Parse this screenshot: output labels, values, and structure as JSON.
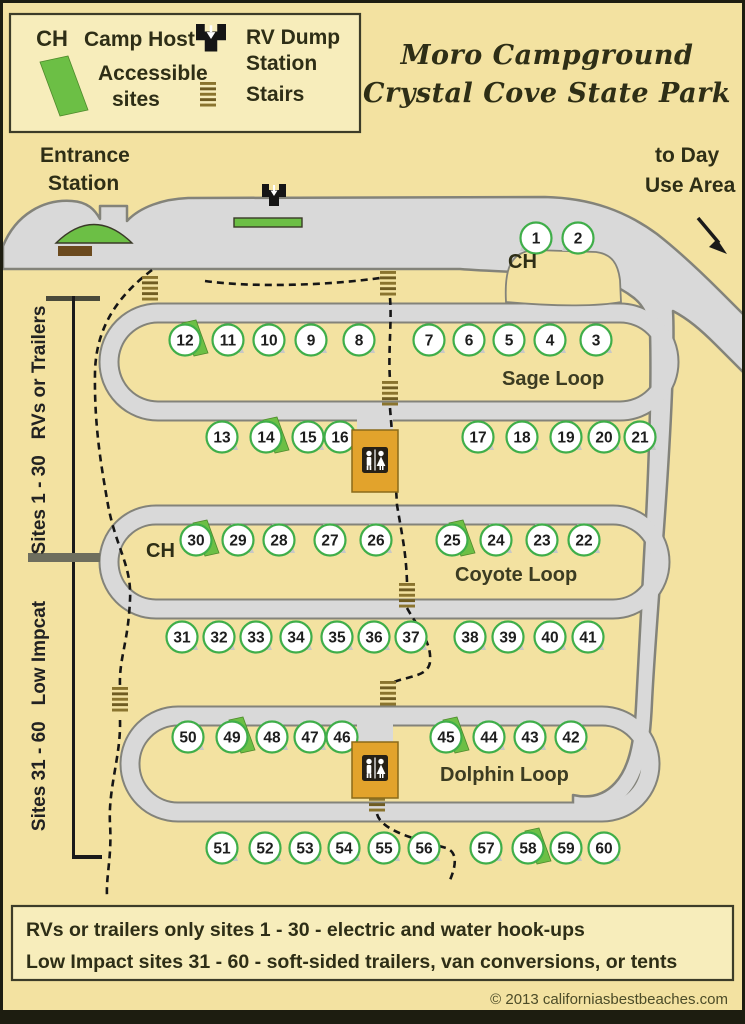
{
  "title": {
    "line1": "Moro Campground",
    "line2": "Crystal Cove State Park"
  },
  "legend": {
    "ch_abbr": "CH",
    "camp_host": "Camp Host",
    "accessible_line1": "Accessible",
    "accessible_line2": "sites",
    "rv_dump_line1": "RV Dump",
    "rv_dump_line2": "Station",
    "stairs": "Stairs"
  },
  "labels": {
    "entrance_line1": "Entrance",
    "entrance_line2": "Station",
    "day_use_line1": "to Day",
    "day_use_line2": "Use Area",
    "ch_near_site_1": "CH",
    "ch_near_site_30": "CH",
    "sage_loop": "Sage Loop",
    "coyote_loop": "Coyote Loop",
    "dolphin_loop": "Dolphin Loop",
    "sites_1_30_bracket": "Sites 1 - 30   RVs or Trailers",
    "sites_31_60_bracket": "Sites 31 - 60   Low Impcat"
  },
  "info_box": {
    "line1": "RVs or trailers only sites 1 - 30 - electric and water hook-ups",
    "line2": "Low Impact sites 31 - 60 - soft-sided trailers, van conversions, or tents"
  },
  "copyright": "© 2013 californiasbestbeaches.com",
  "colors": {
    "background": "#f3e2a1",
    "panel": "#f7edbb",
    "road": "#d9d9d9",
    "road_outline": "#83837a",
    "site_ring_green": "#3fae49",
    "accessible_green": "#6cbf45",
    "pad_gray": "#c7c7c7",
    "restroom_orange": "#e2a32c",
    "stairs_tan": "#8a742e",
    "stairs_tan_dark": "#6f5c22",
    "booth_brown": "#6b4a1e",
    "ink": "#2e2e16",
    "trail_black": "#161616",
    "frame_dark": "#1d1d10"
  },
  "map": {
    "sites": [
      {
        "n": 1,
        "x": 536,
        "y": 238,
        "dir": "L"
      },
      {
        "n": 2,
        "x": 578,
        "y": 238,
        "dir": "L"
      },
      {
        "n": 3,
        "x": 596,
        "y": 340
      },
      {
        "n": 4,
        "x": 550,
        "y": 340
      },
      {
        "n": 5,
        "x": 509,
        "y": 340
      },
      {
        "n": 6,
        "x": 469,
        "y": 340
      },
      {
        "n": 7,
        "x": 429,
        "y": 340
      },
      {
        "n": 8,
        "x": 359,
        "y": 340
      },
      {
        "n": 9,
        "x": 311,
        "y": 340
      },
      {
        "n": 10,
        "x": 269,
        "y": 340
      },
      {
        "n": 11,
        "x": 228,
        "y": 340
      },
      {
        "n": 12,
        "x": 185,
        "y": 340,
        "acc": true
      },
      {
        "n": 13,
        "x": 222,
        "y": 437
      },
      {
        "n": 14,
        "x": 266,
        "y": 437,
        "acc": true
      },
      {
        "n": 15,
        "x": 308,
        "y": 437
      },
      {
        "n": 16,
        "x": 340,
        "y": 437
      },
      {
        "n": 17,
        "x": 478,
        "y": 437
      },
      {
        "n": 18,
        "x": 522,
        "y": 437
      },
      {
        "n": 19,
        "x": 566,
        "y": 437
      },
      {
        "n": 20,
        "x": 604,
        "y": 437
      },
      {
        "n": 21,
        "x": 640,
        "y": 437
      },
      {
        "n": 22,
        "x": 584,
        "y": 540
      },
      {
        "n": 23,
        "x": 542,
        "y": 540
      },
      {
        "n": 24,
        "x": 496,
        "y": 540
      },
      {
        "n": 25,
        "x": 452,
        "y": 540,
        "acc": true
      },
      {
        "n": 26,
        "x": 376,
        "y": 540
      },
      {
        "n": 27,
        "x": 330,
        "y": 540
      },
      {
        "n": 28,
        "x": 279,
        "y": 540
      },
      {
        "n": 29,
        "x": 238,
        "y": 540
      },
      {
        "n": 30,
        "x": 196,
        "y": 540,
        "acc": true
      },
      {
        "n": 31,
        "x": 182,
        "y": 637
      },
      {
        "n": 32,
        "x": 219,
        "y": 637
      },
      {
        "n": 33,
        "x": 256,
        "y": 637
      },
      {
        "n": 34,
        "x": 296,
        "y": 637
      },
      {
        "n": 35,
        "x": 337,
        "y": 637
      },
      {
        "n": 36,
        "x": 374,
        "y": 637
      },
      {
        "n": 37,
        "x": 411,
        "y": 637
      },
      {
        "n": 38,
        "x": 470,
        "y": 637
      },
      {
        "n": 39,
        "x": 508,
        "y": 637
      },
      {
        "n": 40,
        "x": 550,
        "y": 637
      },
      {
        "n": 41,
        "x": 588,
        "y": 637
      },
      {
        "n": 42,
        "x": 571,
        "y": 737
      },
      {
        "n": 43,
        "x": 530,
        "y": 737
      },
      {
        "n": 44,
        "x": 489,
        "y": 737
      },
      {
        "n": 45,
        "x": 446,
        "y": 737,
        "acc": true
      },
      {
        "n": 46,
        "x": 342,
        "y": 737
      },
      {
        "n": 47,
        "x": 310,
        "y": 737
      },
      {
        "n": 48,
        "x": 272,
        "y": 737
      },
      {
        "n": 49,
        "x": 232,
        "y": 737,
        "acc": true
      },
      {
        "n": 50,
        "x": 188,
        "y": 737
      },
      {
        "n": 51,
        "x": 222,
        "y": 848
      },
      {
        "n": 52,
        "x": 265,
        "y": 848
      },
      {
        "n": 53,
        "x": 305,
        "y": 848
      },
      {
        "n": 54,
        "x": 344,
        "y": 848
      },
      {
        "n": 55,
        "x": 384,
        "y": 848
      },
      {
        "n": 56,
        "x": 424,
        "y": 848
      },
      {
        "n": 57,
        "x": 486,
        "y": 848
      },
      {
        "n": 58,
        "x": 528,
        "y": 848,
        "acc": true
      },
      {
        "n": 59,
        "x": 566,
        "y": 848
      },
      {
        "n": 60,
        "x": 604,
        "y": 848
      }
    ],
    "stairs_positions": [
      [
        150,
        276
      ],
      [
        388,
        271
      ],
      [
        390,
        381
      ],
      [
        407,
        583
      ],
      [
        388,
        681
      ],
      [
        120,
        687
      ],
      [
        377,
        787
      ]
    ]
  }
}
